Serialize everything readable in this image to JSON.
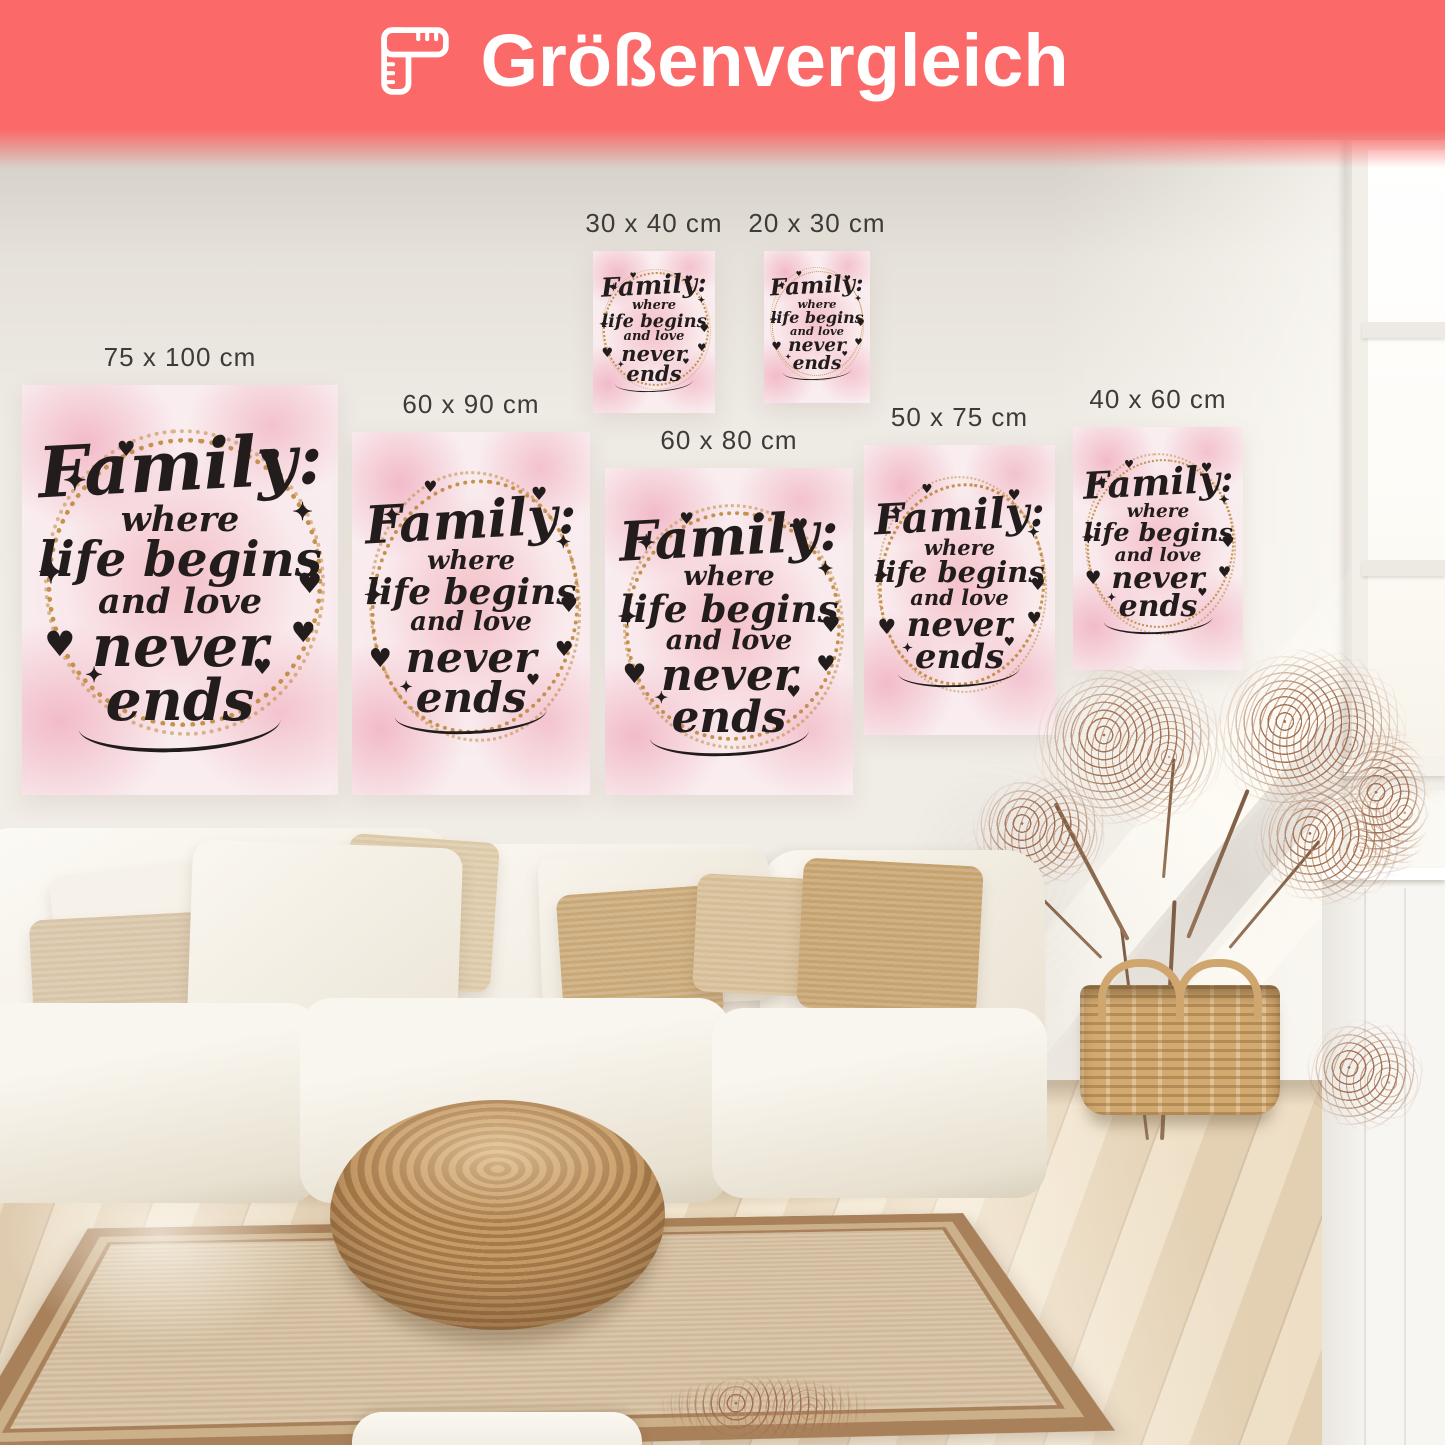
{
  "banner": {
    "title": "Größenvergleich",
    "icon": "corner-ruler-icon",
    "background_color": "#fb6a69",
    "text_color": "#ffffff"
  },
  "posters": [
    {
      "id": "75x100",
      "label": "75 x 100 cm"
    },
    {
      "id": "60x90",
      "label": "60 x 90 cm"
    },
    {
      "id": "30x40",
      "label": "30 x 40 cm"
    },
    {
      "id": "20x30",
      "label": "20 x 30 cm"
    },
    {
      "id": "60x80",
      "label": "60 x 80 cm"
    },
    {
      "id": "50x75",
      "label": "50 x 75 cm"
    },
    {
      "id": "40x60",
      "label": "40 x 60 cm"
    }
  ],
  "poster_art": {
    "line1": "Family:",
    "line2": "where",
    "line3": "life begins",
    "line4": "and love",
    "line5": "never ends",
    "heart_glyph": "♥",
    "sparkle_glyph": "✦",
    "colors": {
      "background_pink": "#f9edef",
      "blotch_pink": "#f0aabc",
      "wreath_gold": "#bf893e",
      "text": "#221d1c"
    }
  },
  "scene": {
    "wall_color": "#ece8e1",
    "floor_wood_color": "#ecdcc0",
    "rug_color": "#d6c1a2",
    "rug_border_color": "#a8805a",
    "sofa_color": "#f7f4ed",
    "pillow_beige_color": "#d8c5a8",
    "pillow_jute_color": "#c09c6d",
    "pouf_wicker_color": "#b98d5c",
    "basket_color": "#d2a96f",
    "dried_plant_color": "#9e6c50"
  }
}
